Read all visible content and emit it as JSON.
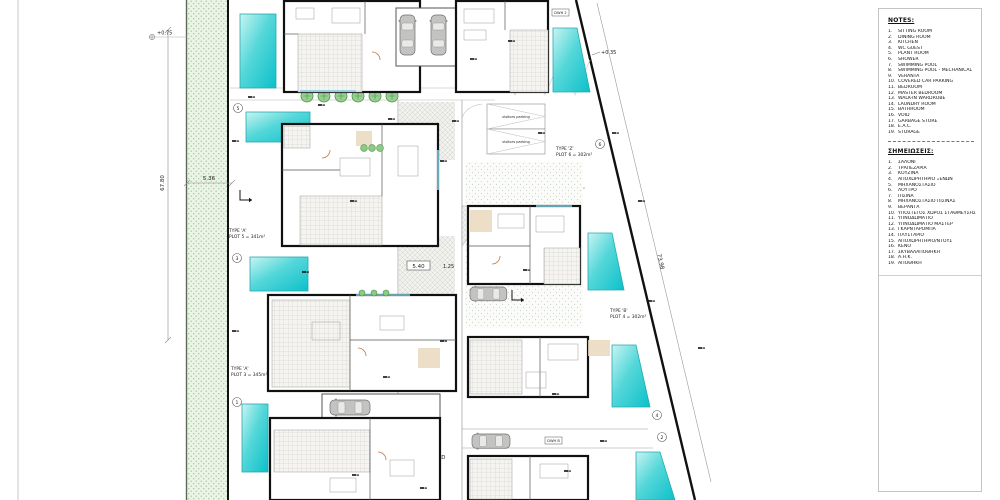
{
  "legend_en": {
    "title": "NOTES:",
    "items": [
      "SITTING ROOM",
      "DINING ROOM",
      "KITCHEN",
      "WC GUEST",
      "PLANT ROOM",
      "SHOWER",
      "SWIMMING POOL",
      "SWIMMING POOL - MECHANICAL",
      "VERANTA",
      "COVERED CAR PARKING",
      "BEDROOM",
      "MASTER BEDROOM",
      "WALK-IN WARDROBE",
      "LAUNDRY ROOM",
      "BATHROOM",
      "VOID",
      "GARBAGE STORE",
      "E.A.C.",
      "STORAGE"
    ]
  },
  "legend_gr": {
    "title": "ΣΗΜΕΙΩΣΕΙΣ:",
    "items": [
      "ΣΑΛΟΝΙ",
      "ΤΡΑΠΕΖΑΡΙΑ",
      "ΚΟΥΖΙΝΑ",
      "ΑΠΟΧΩΡΗΤΗΡΙΟ ΞΕΝΩΝ",
      "ΜΗΧΑΝΟΣΤΑΣΙΟ",
      "ΛΟΥΤΡΟ",
      "ΠΙΣΙΝΑ",
      "ΜΗΧΑΝΟΣΤΑΣΙΟ ΠΙΣΙΝΑΣ",
      "ΒΕΡΑΝΤΑ",
      "ΥΠΟΣΤΕΓΟΣ ΧΩΡΟΣ ΣΤΑΘΜΕΥΣΗΣ",
      "ΥΠΝΟΔΩΜΑΤΙΟ",
      "ΥΠΝΟΔΩΜΑΤΙΟ ΜΑΣΤΕΡ",
      "ΓΚΑΡΝΤΑΡΟΜΠΑ",
      "ΠΛΥΣΤΑΡΙΟ",
      "ΑΠΟΧΩΡΗΤΗΡΙΟ/ΝΤΟΥΣ",
      "ΚΕΝΟ",
      "ΣΚΥΒΑΛΑΠΟΘΗΚΗ",
      "Α.Η.Κ.",
      "ΑΠΟΘΗΚΗ"
    ]
  },
  "labels": {
    "plot5": {
      "l1": "TYPE 'A'",
      "l2": "PLOT 5 = 341m²"
    },
    "plot3": {
      "l1": "TYPE 'A'",
      "l2": "PLOT 3 = 345m²"
    },
    "plot6": {
      "l1": "TYPE 'Z'",
      "l2": "PLOT 6 = 302m²"
    },
    "plot4": {
      "l1": "TYPE 'B'",
      "l2": "PLOT 4 = 302m²"
    },
    "road": {
      "l1": "PRIVATE ROAD",
      "l2": "396m²"
    },
    "visitors": "visitors parking"
  },
  "dims": {
    "site_height": "67.80",
    "strip_width": "5.36",
    "boundary_length": "73.98",
    "road_width": "5.40",
    "road_offset": "1.25"
  },
  "levels": {
    "a": "+0.75",
    "b": "+0.35"
  },
  "plot_numbers": {
    "p1": "1",
    "p2": "2",
    "p3": "3",
    "p4": "4",
    "p5": "5",
    "p6": "6"
  },
  "tags": {
    "dwh2": "DWH 2",
    "dwhb": "DWH B"
  },
  "colors": {
    "pool": "#18c5cf",
    "tree": "#7dc87d",
    "green_strip": "#ecf4e8",
    "wall": "#111111"
  }
}
